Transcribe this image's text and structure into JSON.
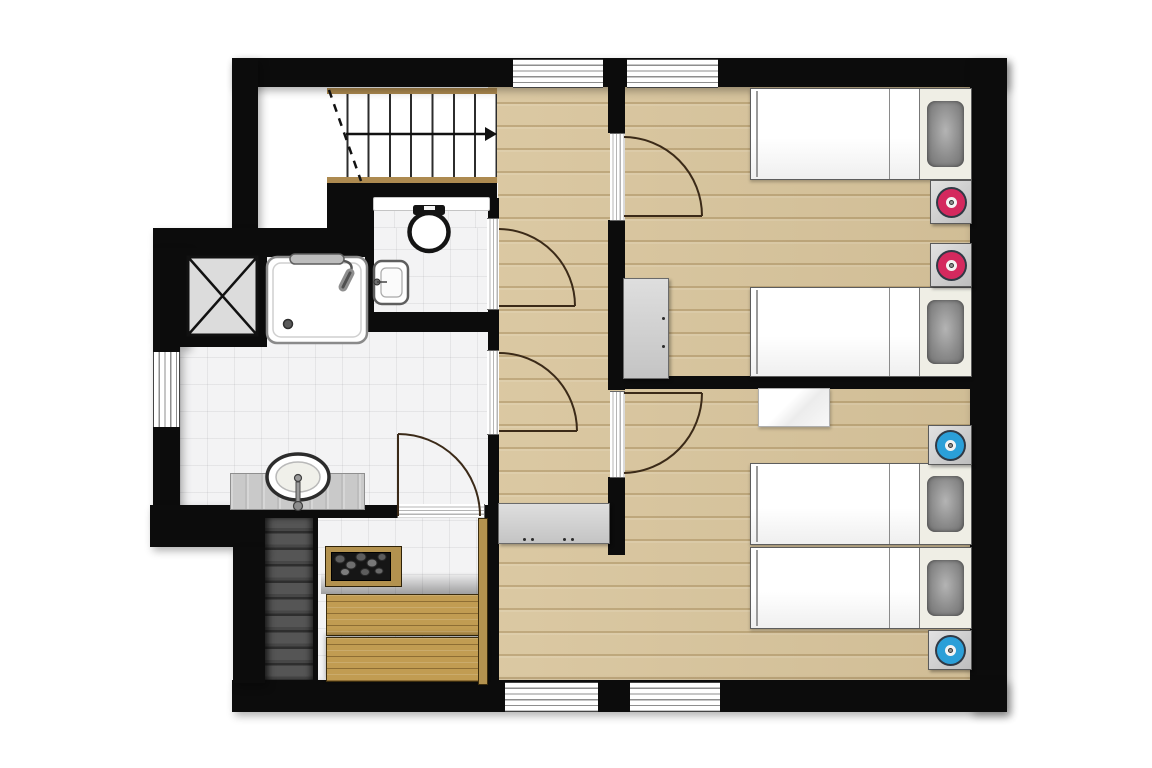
{
  "document_type": "floor-plan",
  "floor_plan": {
    "style": "top-down architectural plan, black walls, no text labels",
    "colors": {
      "wall": "#0c0c0c",
      "wood_floor": "#d8c49b",
      "wood_plank_line": "#82622c",
      "tile_floor": "#f3f3f4",
      "sauna_bench": "#c19c52",
      "sauna_frame": "#3c2d0e",
      "lower_stairs": "#4a4a4a",
      "lamp_pink": "#d4295e",
      "lamp_blue": "#2b9fd8",
      "cabinet_gray": "#d6d6d6",
      "headboard_cream": "#efeee5",
      "pillow_gray": "#8f8f8f",
      "counter_gray": "#c9c9c9",
      "stair_stringer": "#ad8a50",
      "door_line": "#3b2a18"
    },
    "rooms": [
      {
        "name": "staircase",
        "features": [
          "upper flight with 8 treads",
          "direction arrow",
          "dashed cut line",
          "lower dark flight"
        ]
      },
      {
        "name": "wc",
        "fixtures": [
          "toilet",
          "hand-basin",
          "shelf"
        ]
      },
      {
        "name": "bathroom",
        "fixtures": [
          "shower",
          "washing-machine",
          "vanity-sink",
          "counter"
        ]
      },
      {
        "name": "sauna",
        "fixtures": [
          "heater-with-stones",
          "bench-upper",
          "bench-lower",
          "side-plank"
        ]
      },
      {
        "name": "hallway",
        "fixtures": [
          "sideboard-cabinet"
        ]
      },
      {
        "name": "bedroom-north",
        "fixtures": [
          "single-bed",
          "single-bed",
          "nightstand-pink-lamp",
          "nightstand-pink-lamp",
          "wardrobe"
        ]
      },
      {
        "name": "bedroom-south",
        "fixtures": [
          "single-bed",
          "single-bed",
          "nightstand-blue-lamp",
          "nightstand-blue-lamp",
          "white-bench"
        ]
      }
    ],
    "counts": {
      "windows": 5,
      "door_openings": 5,
      "beds": 4,
      "nightstands": 4
    }
  }
}
